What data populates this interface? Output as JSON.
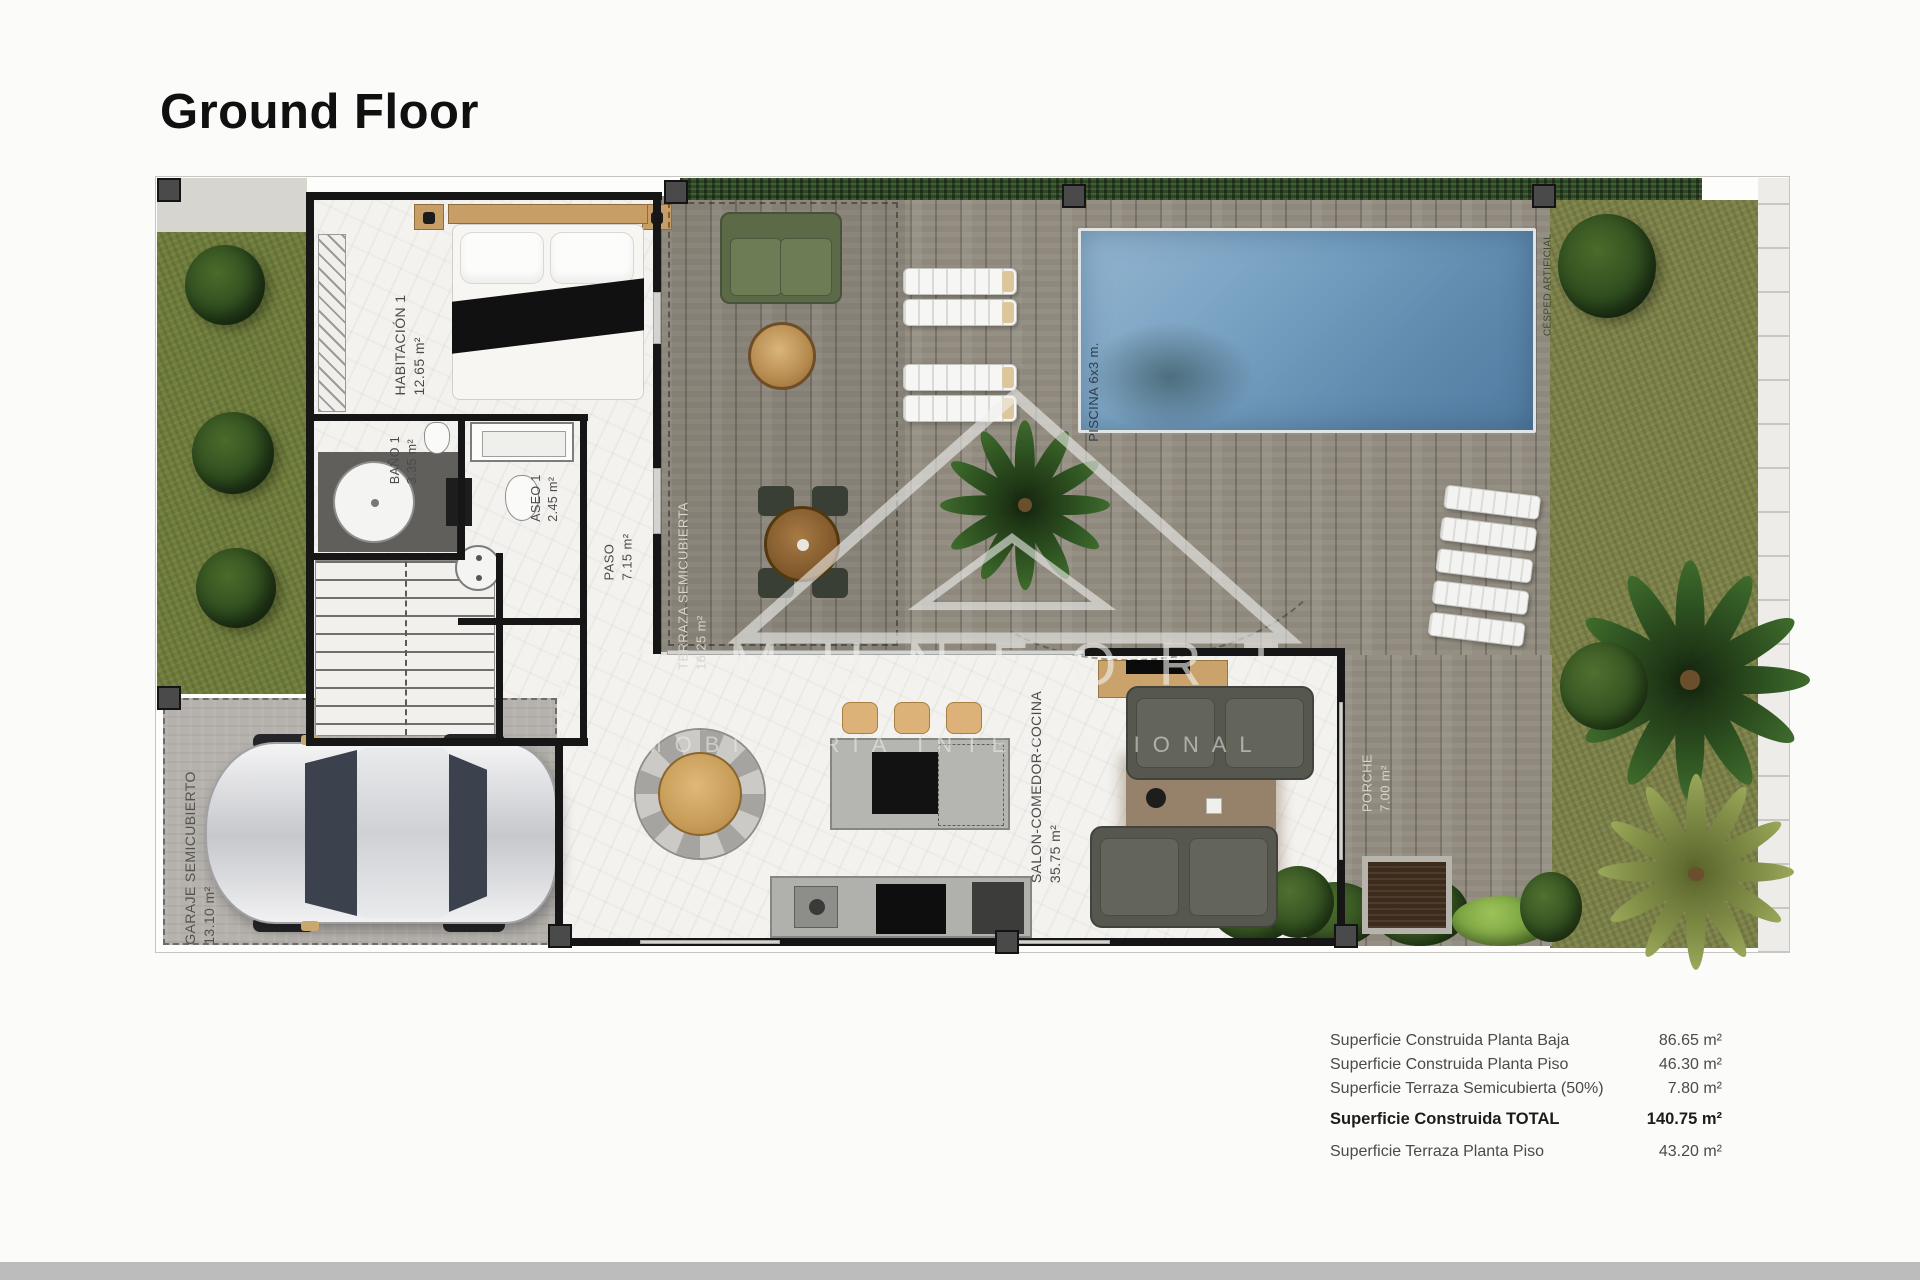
{
  "page": {
    "title": "Ground Floor"
  },
  "watermark": {
    "brand": "MUNFORT",
    "tagline": "INMOBILIARIA INTERNACIONAL"
  },
  "rooms": {
    "bedroom": {
      "name": "HABITACIÓN 1",
      "area": "12.65 m²"
    },
    "bath": {
      "name": "BAÑO 1",
      "area": "3.35 m²"
    },
    "aseo": {
      "name": "ASEO 1",
      "area": "2.45 m²"
    },
    "paso": {
      "name": "PASO",
      "area": "7.15 m²"
    },
    "terraza": {
      "name": "TERRAZA SEMICUBIERTA",
      "area": "16.25 m²"
    },
    "salon": {
      "name": "SALON-COMEDOR-COCINA",
      "area": "35.75 m²"
    },
    "garaje": {
      "name": "GARAJE SEMICUBIERTO",
      "area": "13.10 m²"
    },
    "porche": {
      "name": "PORCHE",
      "area": "7.00 m²"
    },
    "piscina": {
      "name": "PISCINA 6x3 m."
    },
    "garden": {
      "name": "CÉSPED ARTIFICIAL"
    }
  },
  "summary": {
    "rows": [
      {
        "label": "Superficie Construida Planta Baja",
        "value": "86.65 m²"
      },
      {
        "label": "Superficie Construida Planta Piso",
        "value": "46.30 m²"
      },
      {
        "label": "Superficie Terraza Semicubierta (50%)",
        "value": "7.80 m²"
      },
      {
        "label": "Superficie Construida TOTAL",
        "value": "140.75 m²"
      },
      {
        "label": "Superficie Terraza Planta Piso",
        "value": "43.20 m²"
      }
    ]
  },
  "colors": {
    "pool_water": "#6f9cc0",
    "deck_wood": "#8f897d",
    "grass": "#6f7d3b",
    "hedge": "#2d4726",
    "marble_floor": "#f3f2ef",
    "wall": "#161616",
    "footer_strip": "#bcbcbc"
  }
}
